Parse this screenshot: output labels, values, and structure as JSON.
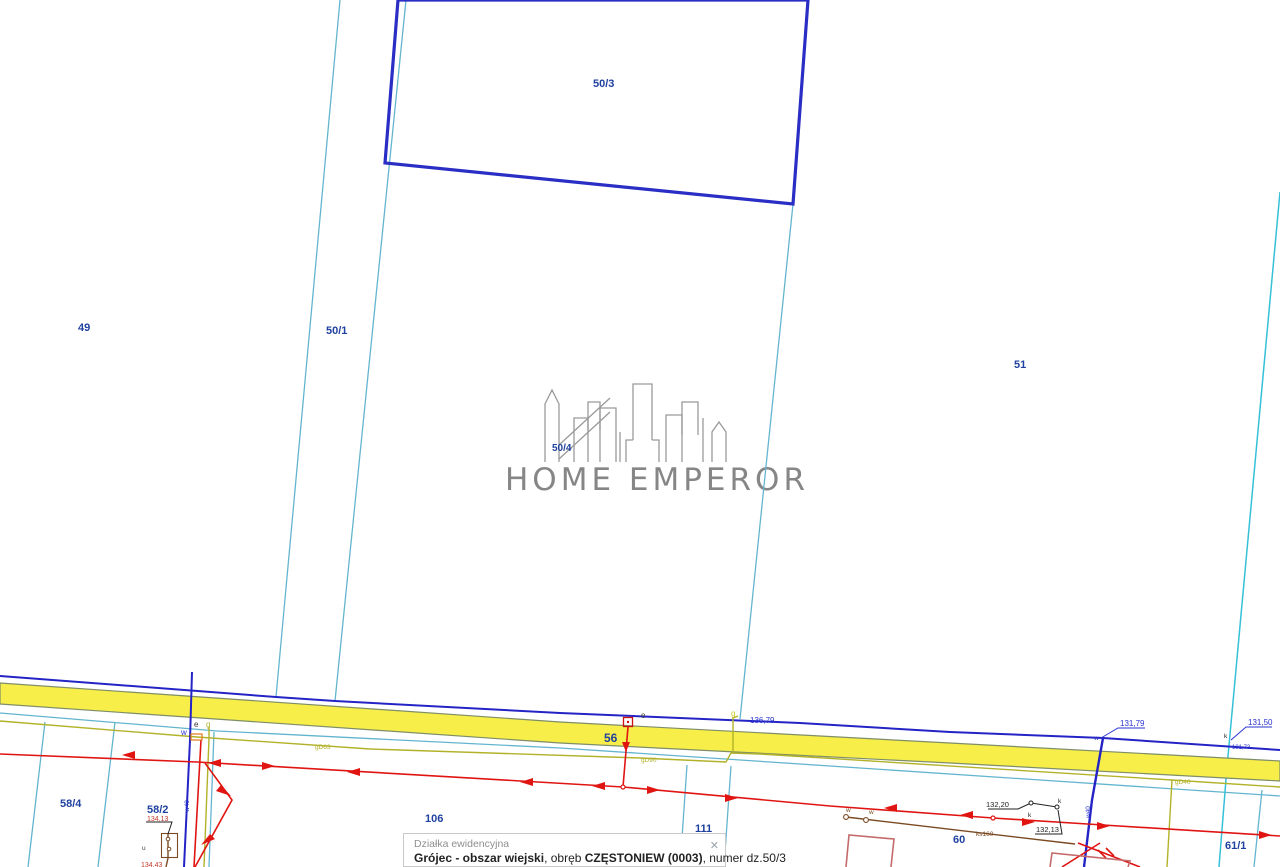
{
  "watermark": {
    "brand": "HOME EMPEROR"
  },
  "parcels": {
    "p49": "49",
    "p50_1": "50/1",
    "p50_3": "50/3",
    "p50_4": "50/4",
    "p51": "51",
    "p56": "56",
    "p58_4": "58/4",
    "p58_2": "58/2",
    "p106": "106",
    "p111": "111",
    "p60": "60",
    "p61_1": "61/1"
  },
  "measurements": {
    "m136_79": "136,79",
    "m131_79": "131,79",
    "m131_50": "131,50",
    "m131_73": "131,73",
    "m132_20": "132,20",
    "m132_13": "132,13",
    "m134_13": "134,13",
    "m134_43": "134,43"
  },
  "utilities": {
    "w_left": "w40",
    "w_right": "w40",
    "g_label_1": "gD63",
    "g_label_2": "gD90",
    "g_label_3": "gD40",
    "ks_label": "ks160",
    "tick_w": "w",
    "tick_e": "e",
    "tick_g": "g",
    "tick_k": "k",
    "tick_u": "u"
  },
  "infobox": {
    "title": "Działka ewidencyjna",
    "name_bold": "Grójec - obszar wiejski",
    "sep_obreb": ", obręb ",
    "obreb_bold": "CZĘSTONIEW (0003)",
    "rest": ", numer dz.50/3",
    "close_icon": "✕"
  },
  "colors": {
    "parcel_line": "#63b5cf",
    "bright_parcel_line": "#35c0d7",
    "selected_parcel": "#2a2ec4",
    "road_line_blue": "#2424c6",
    "road_fill_yellow": "#f8ee4a",
    "road_border": "#7e8e66",
    "power_red": "#e01512",
    "gas_olive": "#b2b22a",
    "sewer_brown": "#7a4a22",
    "building_salmon": "#c46a6a",
    "label_blue": "#1f419f",
    "measure_blue": "#2a35cf"
  }
}
